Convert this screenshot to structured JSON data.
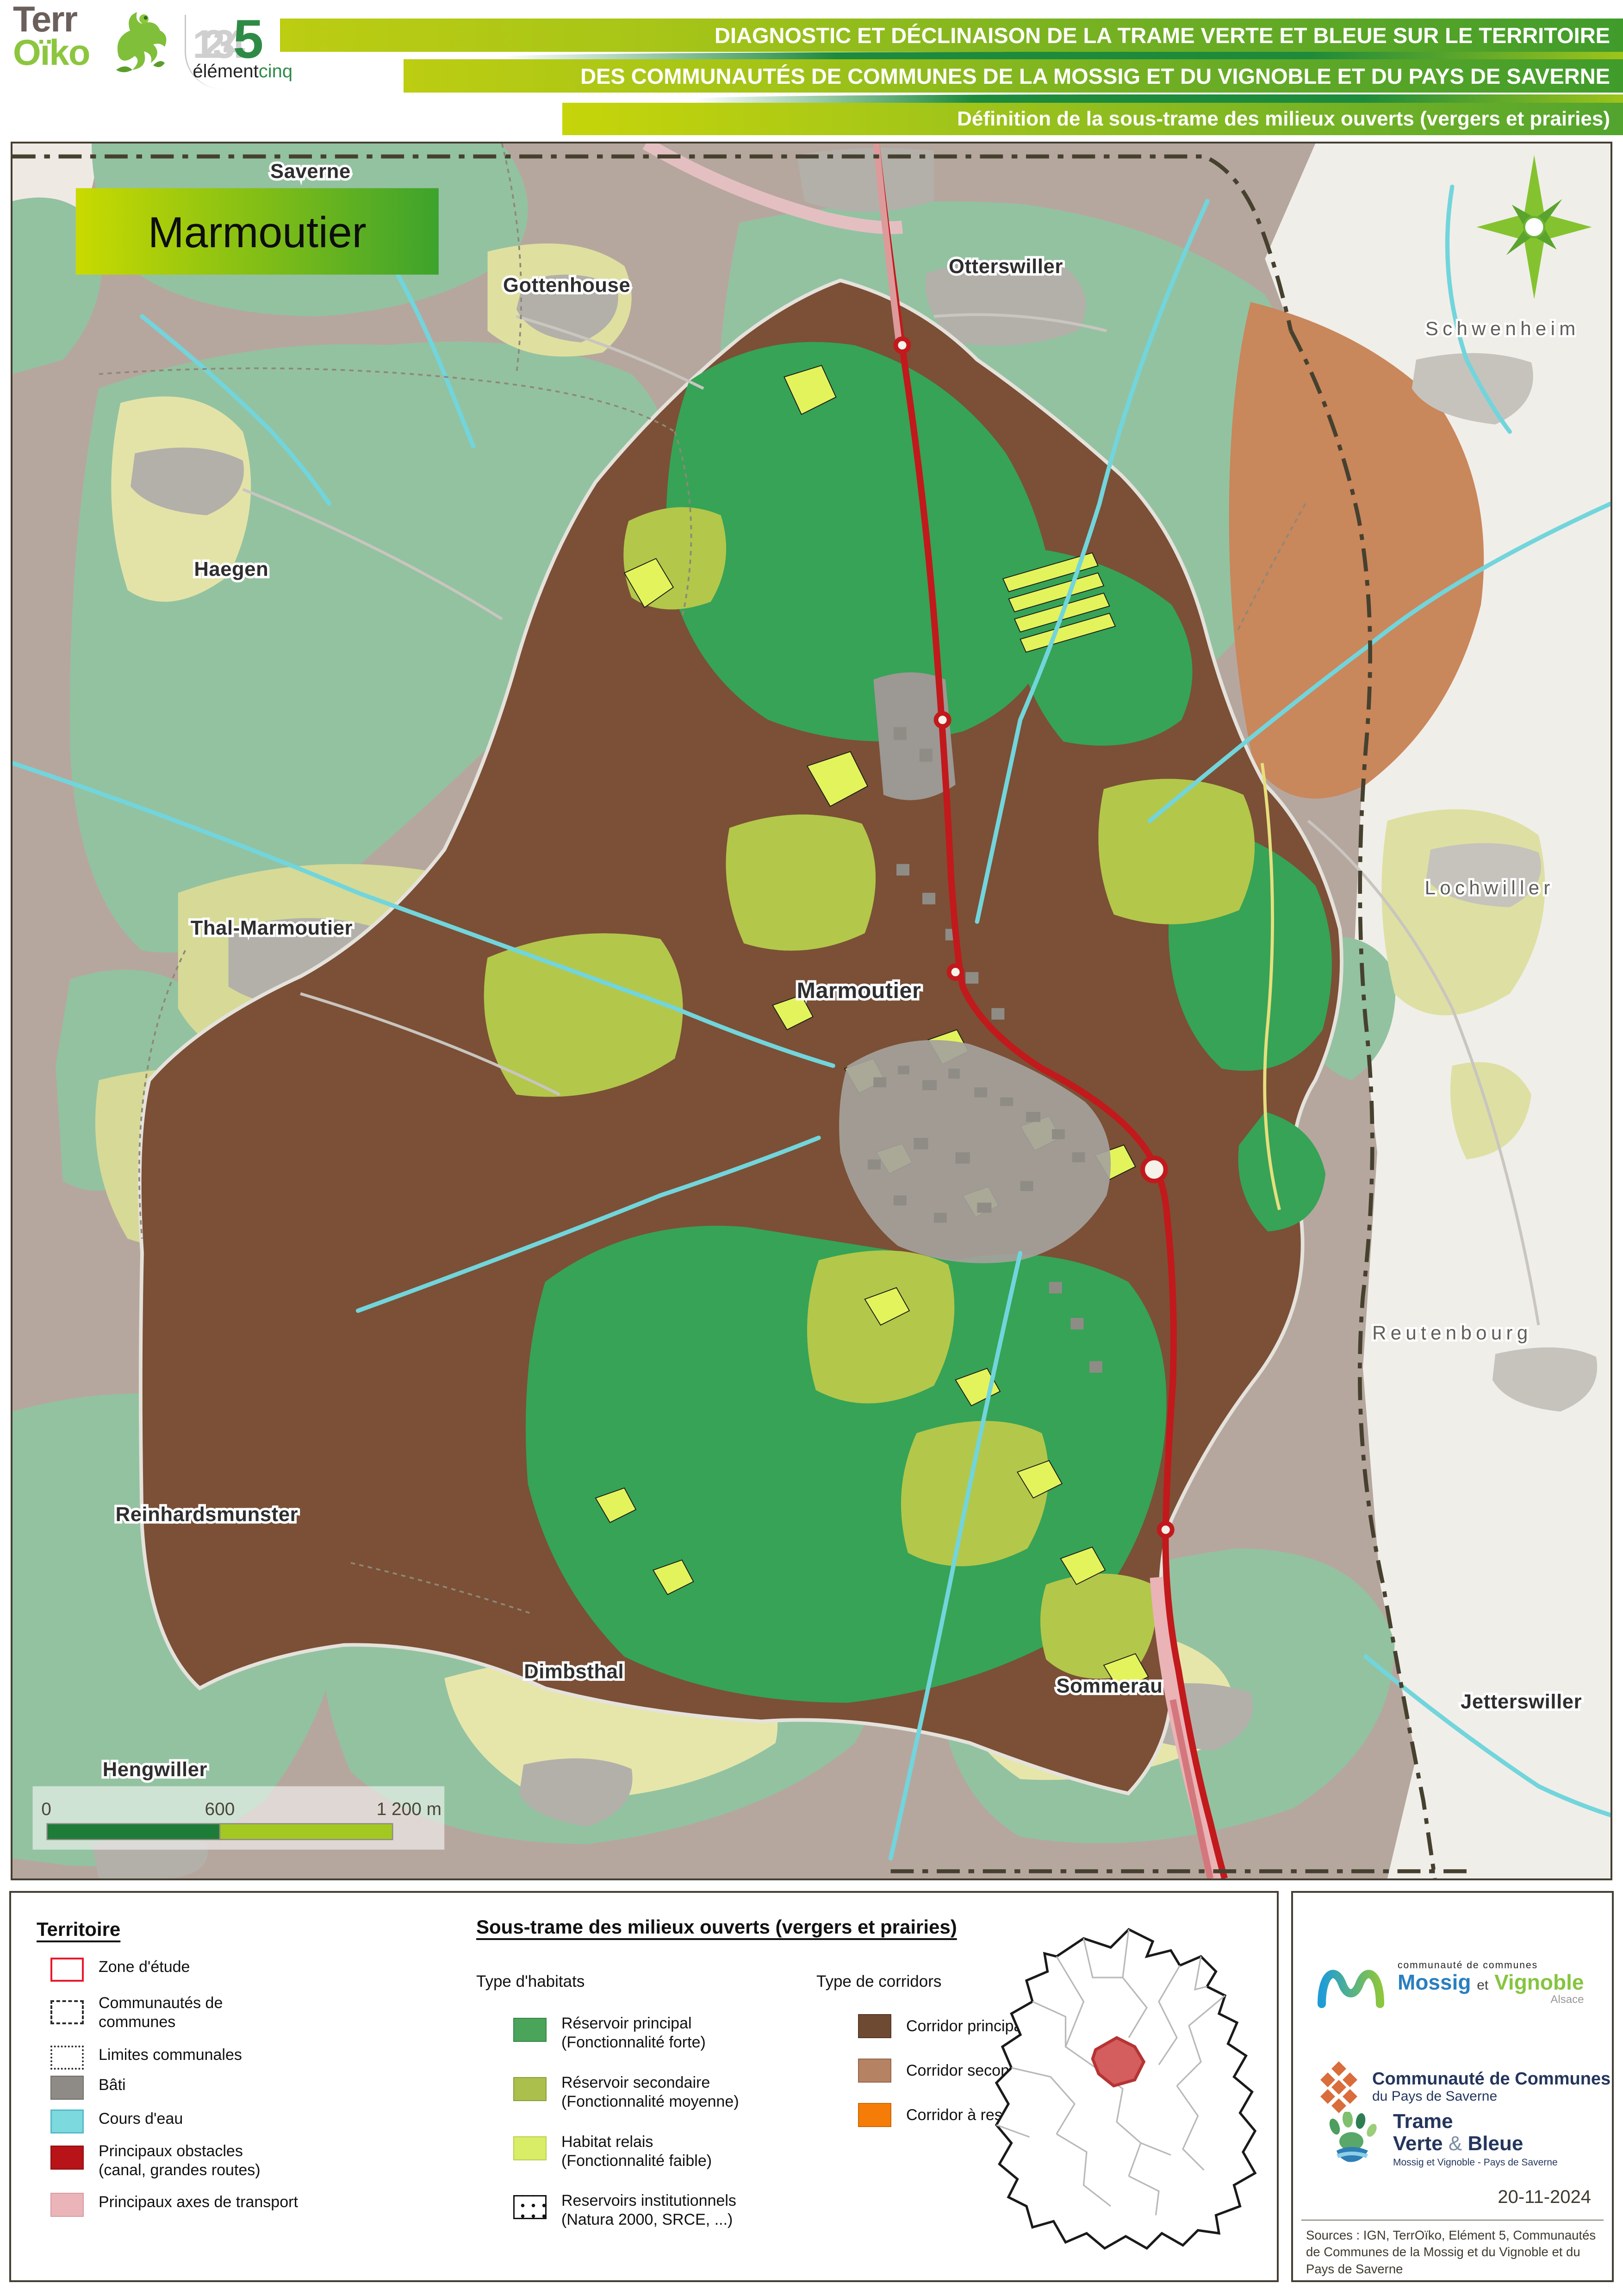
{
  "header": {
    "brand_terroiko": {
      "terr": "Terr",
      "oiko": "Oïko"
    },
    "brand_element5": {
      "nums": "1234",
      "five": "5",
      "element": "élément",
      "cinq": "cinq"
    },
    "title_line1": "DIAGNOSTIC ET DÉCLINAISON DE LA TRAME VERTE ET BLEUE SUR LE TERRITOIRE",
    "title_line2": "DES COMMUNAUTÉS DE COMMUNES DE LA MOSSIG ET DU VIGNOBLE ET DU PAYS DE SAVERNE",
    "subtitle": "Définition de la sous-trame des milieux ouverts (vergers et prairies)"
  },
  "map": {
    "frame_title": "Marmoutier",
    "towns": [
      "Saverne",
      "Gottenhouse",
      "Otterswiller",
      "Schwenheim",
      "Haegen",
      "Thal-Marmoutier",
      "Lochwiller",
      "Marmoutier",
      "Reutenbourg",
      "Reinhardsmunster",
      "Dimbsthal",
      "Sommerau",
      "Jetterswiller",
      "Hengwiller"
    ],
    "scale": {
      "start": "0",
      "mid": "600",
      "end": "1 200 m"
    }
  },
  "legend": {
    "territoire": {
      "heading": "Territoire",
      "items": [
        {
          "label": "Zone d'étude",
          "label2": ""
        },
        {
          "label": "Communautés de",
          "label2": "communes"
        },
        {
          "label": "Limites communales",
          "label2": ""
        },
        {
          "label": "Bâti",
          "label2": ""
        },
        {
          "label": "Cours d'eau",
          "label2": ""
        },
        {
          "label": "Principaux obstacles",
          "label2": "(canal, grandes routes)"
        },
        {
          "label": "Principaux axes de transport",
          "label2": ""
        }
      ]
    },
    "sous_trame": {
      "heading": "Sous-trame des milieux ouverts (vergers et prairies)",
      "habitats_heading": "Type d'habitats",
      "habitats": [
        {
          "label": "Réservoir principal",
          "sub": "(Fonctionnalité forte)"
        },
        {
          "label": "Réservoir secondaire",
          "sub": "(Fonctionnalité moyenne)"
        },
        {
          "label": "Habitat relais",
          "sub": "(Fonctionnalité faible)"
        },
        {
          "label": "Reservoirs institutionnels",
          "sub": "(Natura 2000, SRCE, ...)"
        }
      ],
      "corridors_heading": "Type de corridors",
      "corridors": [
        {
          "label": "Corridor principal"
        },
        {
          "label": "Corridor secondaire"
        },
        {
          "label": "Corridor à restaurer"
        }
      ]
    }
  },
  "panel": {
    "mossig": {
      "small": "communauté de communes",
      "name1": "Mossig",
      "et": "et",
      "name2": "Vignoble",
      "region": "Alsace"
    },
    "saverne": {
      "line1": "Communauté de Communes",
      "line2": "du Pays de Saverne"
    },
    "tvb": {
      "line1": "Trame",
      "line2a": "Verte",
      "amp": "&",
      "line2b": "Bleue",
      "sub": "Mossig et Vignoble - Pays de Saverne"
    },
    "date": "20-11-2024",
    "sources": "Sources : IGN, TerrOïko, Elément 5, Communautés de Communes de la Mossig et du Vignoble et du Pays de Saverne"
  },
  "colors": {
    "zone_etude": "#e8192c",
    "bati": "#8e8b86",
    "cours_eau": "#7cd9de",
    "obstacles": "#b71318",
    "axes_transport": "#eab4b8",
    "reservoir_principal": "#4aa55b",
    "reservoir_secondaire": "#aabf4c",
    "habitat_relais": "#d9ee66",
    "corridor_principal": "#6f4a32",
    "corridor_secondaire": "#b58264",
    "corridor_restaurer": "#f57d07"
  }
}
